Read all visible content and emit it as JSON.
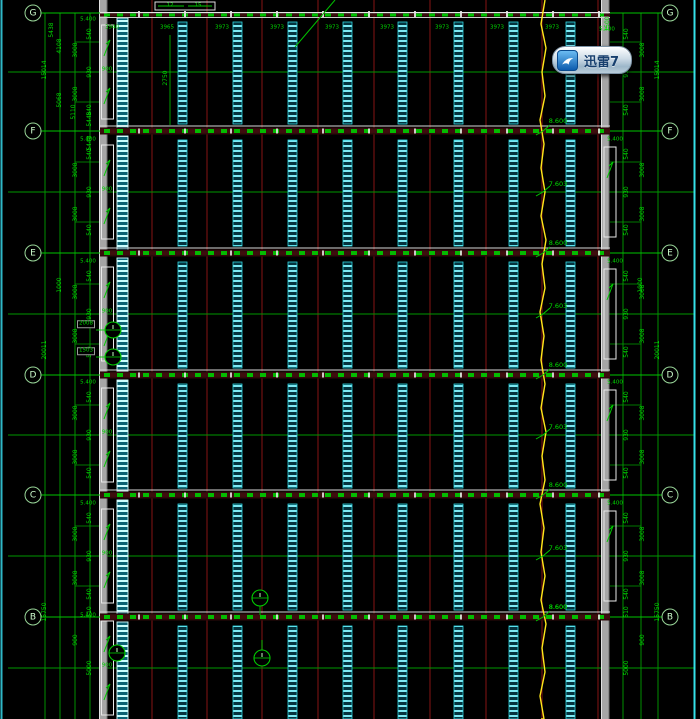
{
  "watermark": {
    "label": "迅雷7"
  },
  "grid": {
    "row_labels": [
      "G",
      "F",
      "E",
      "D",
      "C",
      "B"
    ]
  },
  "top_dims": [
    "3940",
    "3965",
    "3973",
    "3973",
    "3973",
    "3973",
    "3973",
    "3973",
    "3973"
  ],
  "levels": {
    "high": "8.600",
    "low": "7.603",
    "wall": "5.400"
  },
  "dims": {
    "bay": {
      "end": "540",
      "segment": "3008",
      "mid": "930"
    },
    "totals": [
      "15014",
      "20011",
      "15750"
    ],
    "upper_left": [
      "5438",
      "4108",
      "5068",
      "5110",
      "2750"
    ],
    "bottom": [
      "510",
      "900",
      "5000"
    ],
    "extra": {
      "k1000": "1000",
      "d5448": "5448",
      "v1500": "1500",
      "boxed_a": "2008",
      "boxed_b": "1503"
    },
    "opening_width": "900",
    "box_small": [
      "12",
      "15"
    ]
  }
}
